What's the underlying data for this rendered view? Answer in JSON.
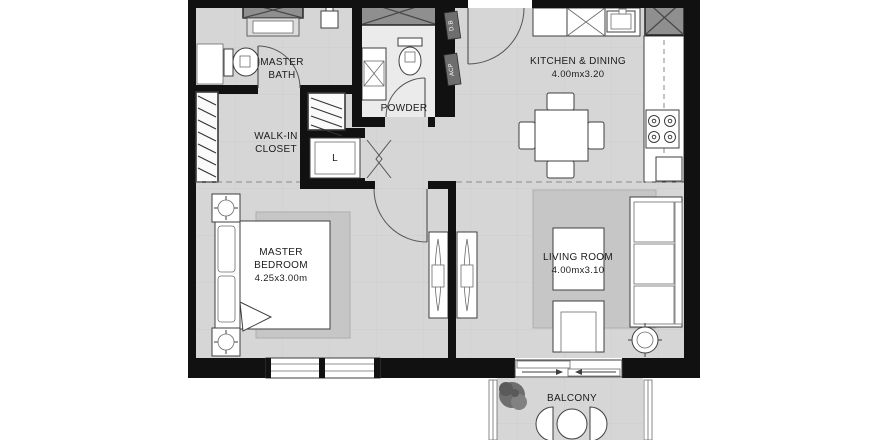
{
  "colors": {
    "wall": "#111111",
    "floor": "#d6d6d6",
    "rug": "#c6c6c6",
    "shaft": "#8f8f8f",
    "powderFloor": "#ebebeb"
  },
  "rooms": {
    "master_bath": {
      "line1": "MASTER",
      "line2": "BATH"
    },
    "walk_in_closet": {
      "line1": "WALK-IN",
      "line2": "CLOSET"
    },
    "powder": {
      "label": "POWDER"
    },
    "kitchen_dining": {
      "label": "KITCHEN & DINING",
      "dims": "4.00mx3.20"
    },
    "master_bedroom": {
      "line1": "MASTER",
      "line2": "BEDROOM",
      "dims": "4.25x3.00m"
    },
    "living_room": {
      "label": "LIVING ROOM",
      "dims": "4.00mx3.10"
    },
    "balcony": {
      "label": "BALCONY"
    },
    "laundry": {
      "label": "L"
    }
  },
  "wall_tags": {
    "db": "D.B",
    "acp": "ACP"
  }
}
